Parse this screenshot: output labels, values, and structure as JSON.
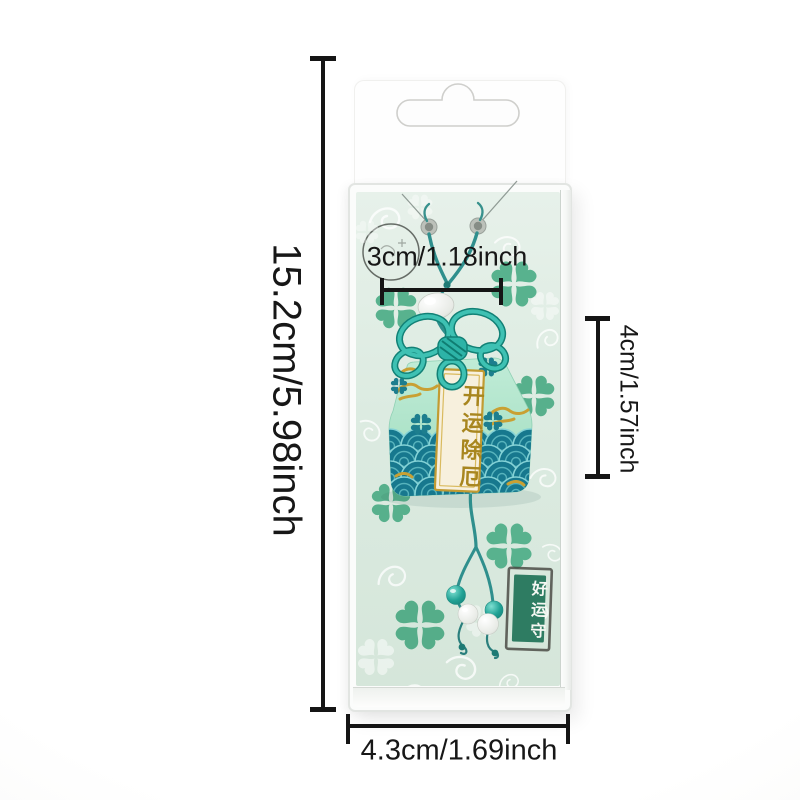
{
  "photo": {
    "description": "Mint green omamori lucky-charm amulet sealed in a clear plastic blister package on a white background, annotated with printed dimension lines"
  },
  "annotations": {
    "package_height": "15.2cm/5.98inch",
    "charm_width": "3cm/1.18inch",
    "charm_height": "4cm/1.57inch",
    "package_width": "4.3cm/1.69inch"
  },
  "charm": {
    "blessing_tag": "开运除厄",
    "stamp": "好运守"
  },
  "colors": {
    "knot_teal": "#2db3a7",
    "body_mint": "#b0e4ca",
    "wave_teal": "#17788e",
    "embroidery_gold": "#c9a033",
    "stamp_green": "#2e7c62",
    "clover_green": "#58b28e",
    "card_green": "#dcebe1",
    "annotation_black": "#151515"
  }
}
